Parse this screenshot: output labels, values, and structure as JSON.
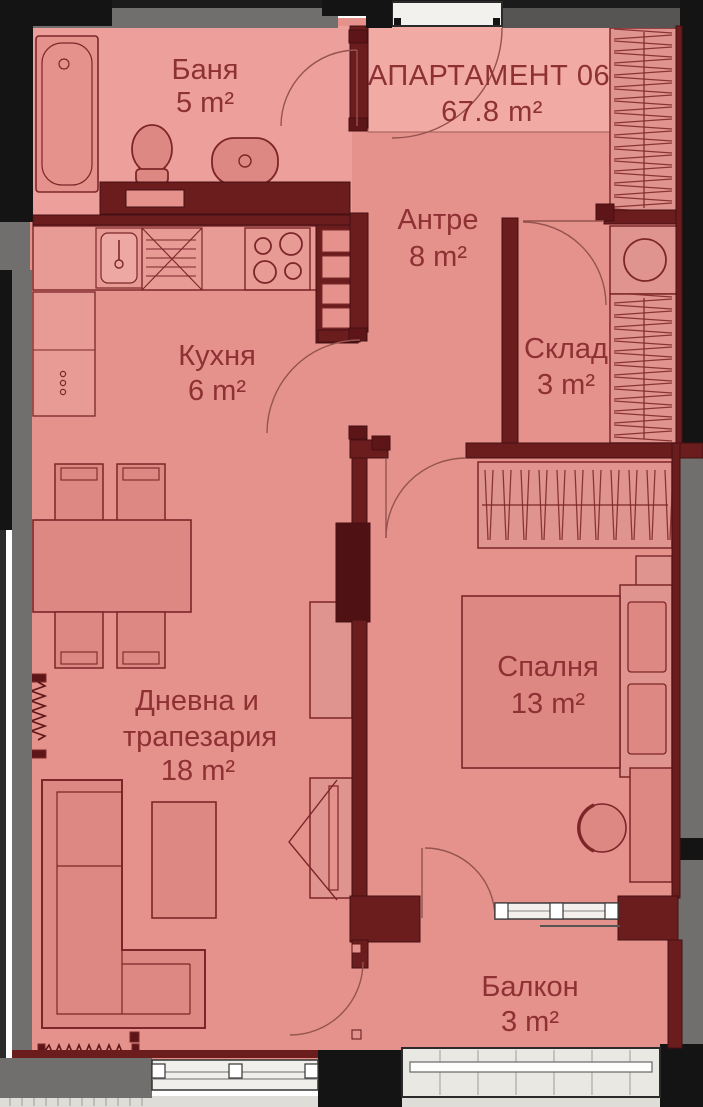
{
  "title": {
    "line1": "АПАРТАМЕНТ 06",
    "line2": "67.8 m²"
  },
  "rooms": {
    "bathroom": {
      "label": "Баня",
      "area": "5 m²"
    },
    "entry": {
      "label": "Антре",
      "area": "8 m²"
    },
    "storage": {
      "label": "Склад",
      "area": "3 m²"
    },
    "kitchen": {
      "label": "Кухня",
      "area": "6 m²"
    },
    "bedroom": {
      "label": "Спалня",
      "area": "13 m²"
    },
    "living": {
      "line1": "Дневна и",
      "line2": "трапезария",
      "area": "18 m²"
    },
    "balcony": {
      "label": "Балкон",
      "area": "3 m²"
    }
  },
  "colors": {
    "floor": "#e5918c",
    "floor_bathroom": "#eda09b",
    "title_zone": "#f1aaa4",
    "wall_maroon": "#6b1d1e",
    "wall_column": "#4f1113",
    "wall_gray": "#716f6d",
    "wall_black": "#141414",
    "furniture_fill": "#dd8882",
    "furniture_stroke": "#7c2629",
    "label_text": "#8e3134",
    "door_white": "#f2f1ee"
  }
}
